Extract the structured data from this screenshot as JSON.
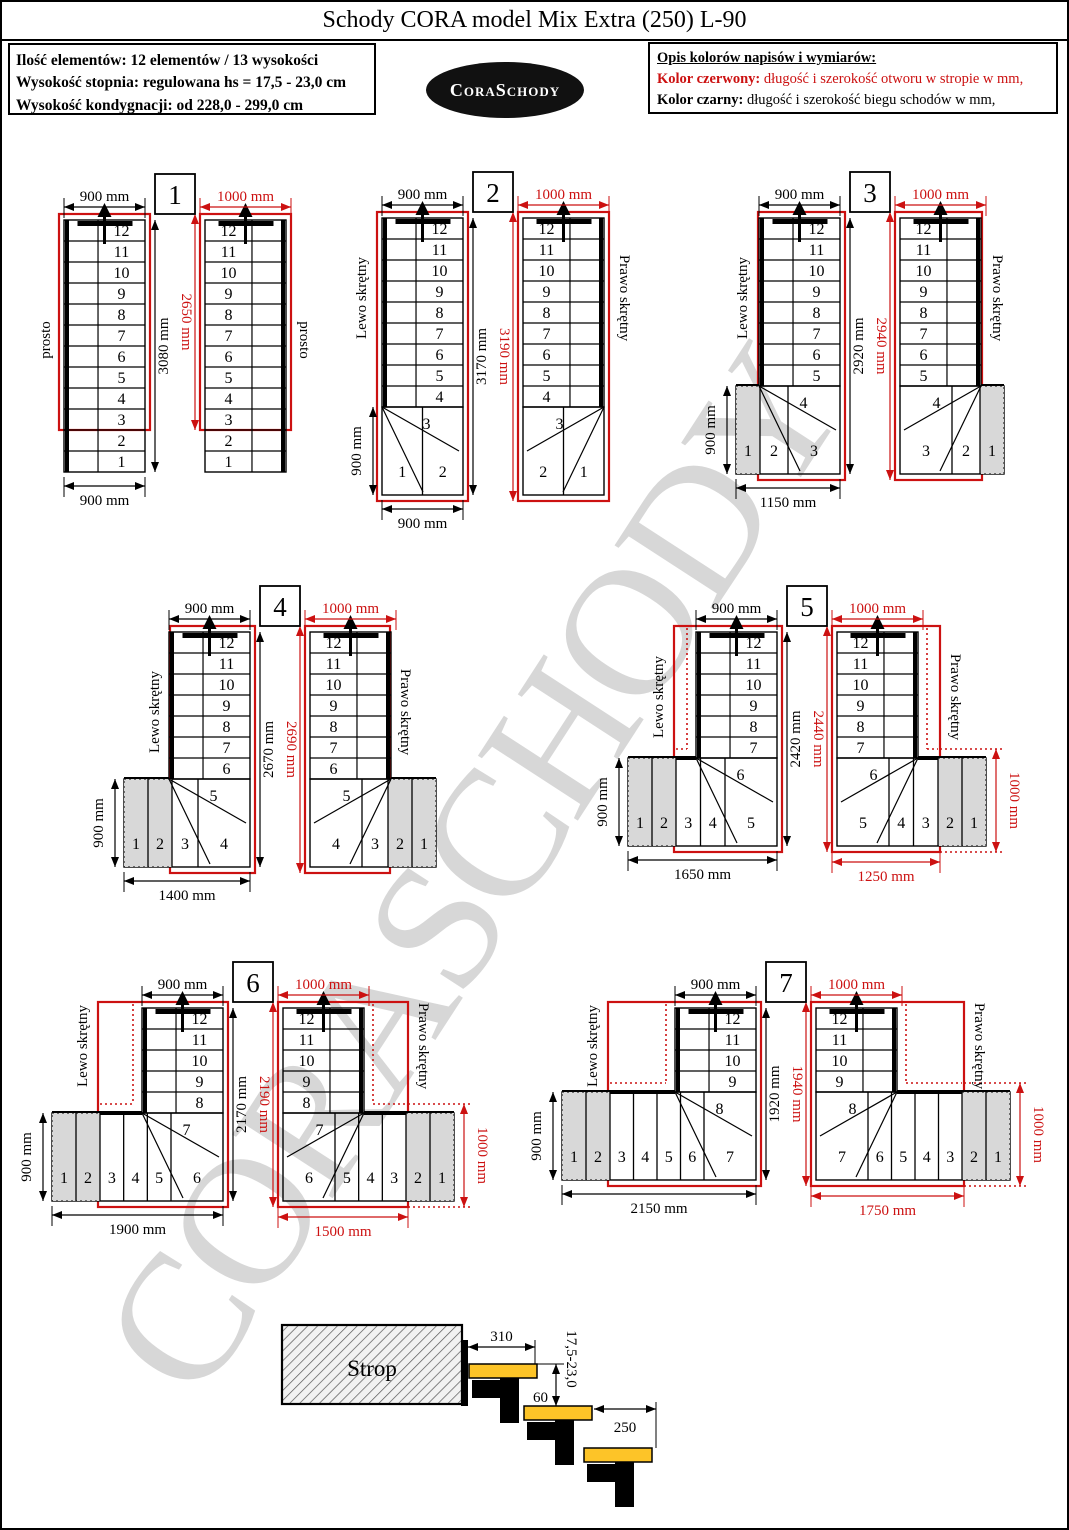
{
  "page": {
    "title": "Schody CORA model Mix Extra (250) L-90"
  },
  "info_box": {
    "lines": [
      "Ilość elementów: 12 elementów / 13 wysokości",
      "Wysokość stopnia: regulowana  hs = 17,5 - 23,0 cm",
      "Wysokość kondygnacji: od 228,0 - 299,0 cm"
    ]
  },
  "logo": {
    "text": "CoraSchody"
  },
  "legend": {
    "heading": "Opis kolorów napisów i wymiarów:",
    "red_label": "Kolor czerwony:",
    "red_desc": " długość i szerokość otworu w stropie w mm,",
    "black_label": "Kolor czarny:",
    "black_desc": " długość i szerokość biegu schodów w mm,"
  },
  "watermark": "CORASCHODY",
  "colors": {
    "red": "#cc1111",
    "black": "#000000",
    "tread_yellow": "#fdc428",
    "shade_gray": "#d8d8d8",
    "watermark_gray": "#d7d7d7"
  },
  "diagrams": [
    {
      "number": "1",
      "left": {
        "type": "prosto",
        "top": "900 mm",
        "height_black": "3080 mm",
        "height_red": "2650 mm",
        "bottom": "900 mm",
        "side": null,
        "steps": [
          "12",
          "11",
          "10",
          "9",
          "8",
          "7",
          "6",
          "5",
          "4",
          "3",
          "2",
          "1"
        ],
        "winder": null,
        "bottom_steps": [],
        "shaded": 0
      },
      "right": {
        "type": "prosto",
        "top_red": "1000 mm",
        "steps": [
          "12",
          "11",
          "10",
          "9",
          "8",
          "7",
          "6",
          "5",
          "4",
          "3",
          "2",
          "1"
        ],
        "winder": null,
        "bottom_steps": [],
        "shaded": 0,
        "bottom_red": null,
        "side_red": null
      }
    },
    {
      "number": "2",
      "left": {
        "type": "Lewo skrętny",
        "top": "900 mm",
        "height_black": "3170 mm",
        "height_red": "3190 mm",
        "bottom": "900 mm",
        "side": "900 mm",
        "steps": [
          "12",
          "11",
          "10",
          "9",
          "8",
          "7",
          "6",
          "5",
          "4"
        ],
        "winder": "3",
        "bottom_steps": [
          "1",
          "2"
        ],
        "shaded": 0
      },
      "right": {
        "type": "Prawo skrętny",
        "top_red": "1000 mm",
        "steps": [
          "12",
          "11",
          "10",
          "9",
          "8",
          "7",
          "6",
          "5",
          "4"
        ],
        "winder": "3",
        "bottom_steps": [
          "2",
          "1"
        ],
        "shaded": 0,
        "bottom_red": null,
        "side_red": null
      }
    },
    {
      "number": "3",
      "left": {
        "type": "Lewo skrętny",
        "top": "900 mm",
        "height_black": "2920 mm",
        "height_red": "2940 mm",
        "bottom": "1150 mm",
        "side": "900 mm",
        "steps": [
          "12",
          "11",
          "10",
          "9",
          "8",
          "7",
          "6",
          "5"
        ],
        "winder": "4",
        "bottom_steps": [
          "1",
          "2",
          "3"
        ],
        "shaded": 1
      },
      "right": {
        "type": "Prawo skrętny",
        "top_red": "1000 mm",
        "steps": [
          "12",
          "11",
          "10",
          "9",
          "8",
          "7",
          "6",
          "5"
        ],
        "winder": "4",
        "bottom_steps": [
          "3",
          "2",
          "1"
        ],
        "shaded": 1,
        "bottom_red": null,
        "side_red": null
      }
    },
    {
      "number": "4",
      "left": {
        "type": "Lewo skrętny",
        "top": "900 mm",
        "height_black": "2670 mm",
        "height_red": "2690 mm",
        "bottom": "1400 mm",
        "side": "900 mm",
        "steps": [
          "12",
          "11",
          "10",
          "9",
          "8",
          "7",
          "6"
        ],
        "winder": "5",
        "bottom_steps": [
          "1",
          "2",
          "3",
          "4"
        ],
        "shaded": 2
      },
      "right": {
        "type": "Prawo skrętny",
        "top_red": "1000 mm",
        "steps": [
          "12",
          "11",
          "10",
          "9",
          "8",
          "7",
          "6"
        ],
        "winder": "5",
        "bottom_steps": [
          "4",
          "3",
          "2",
          "1"
        ],
        "shaded": 2,
        "bottom_red": null,
        "side_red": null
      }
    },
    {
      "number": "5",
      "left": {
        "type": "Lewo skrętny",
        "top": "900 mm",
        "height_black": "2420 mm",
        "height_red": "2440 mm",
        "bottom": "1650 mm",
        "side": "900 mm",
        "steps": [
          "12",
          "11",
          "10",
          "9",
          "8",
          "7"
        ],
        "winder": "6",
        "bottom_steps": [
          "1",
          "2",
          "3",
          "4",
          "5"
        ],
        "shaded": 2
      },
      "right": {
        "type": "Prawo skrętny",
        "top_red": "1000 mm",
        "steps": [
          "12",
          "11",
          "10",
          "9",
          "8",
          "7"
        ],
        "winder": "6",
        "bottom_steps": [
          "5",
          "4",
          "3",
          "2",
          "1"
        ],
        "shaded": 2,
        "bottom_red": "1250 mm",
        "side_red": "1000 mm"
      }
    },
    {
      "number": "6",
      "left": {
        "type": "Lewo skrętny",
        "top": "900 mm",
        "height_black": "2170 mm",
        "height_red": "2190 mm",
        "bottom": "1900 mm",
        "side": "900 mm",
        "steps": [
          "12",
          "11",
          "10",
          "9",
          "8"
        ],
        "winder": "7",
        "bottom_steps": [
          "1",
          "2",
          "3",
          "4",
          "5",
          "6"
        ],
        "shaded": 2
      },
      "right": {
        "type": "Prawo skrętny",
        "top_red": "1000 mm",
        "steps": [
          "12",
          "11",
          "10",
          "9",
          "8"
        ],
        "winder": "7",
        "bottom_steps": [
          "6",
          "5",
          "4",
          "3",
          "2",
          "1"
        ],
        "shaded": 2,
        "bottom_red": "1500 mm",
        "side_red": "1000 mm"
      }
    },
    {
      "number": "7",
      "left": {
        "type": "Lewo skrętny",
        "top": "900 mm",
        "height_black": "1920 mm",
        "height_red": "1940 mm",
        "bottom": "2150 mm",
        "side": "900 mm",
        "steps": [
          "12",
          "11",
          "10",
          "9"
        ],
        "winder": "8",
        "bottom_steps": [
          "1",
          "2",
          "3",
          "4",
          "5",
          "6",
          "7"
        ],
        "shaded": 2
      },
      "right": {
        "type": "Prawo skrętny",
        "top_red": "1000 mm",
        "steps": [
          "12",
          "11",
          "10",
          "9"
        ],
        "winder": "8",
        "bottom_steps": [
          "7",
          "6",
          "5",
          "4",
          "3",
          "2",
          "1"
        ],
        "shaded": 2,
        "bottom_red": "1750 mm",
        "side_red": "1000 mm"
      }
    }
  ],
  "side_view": {
    "strop_label": "Strop",
    "dim_top_tread": "310",
    "dim_nosing": "60",
    "dim_rise_range": "17,5-23,0",
    "dim_tread": "250"
  }
}
